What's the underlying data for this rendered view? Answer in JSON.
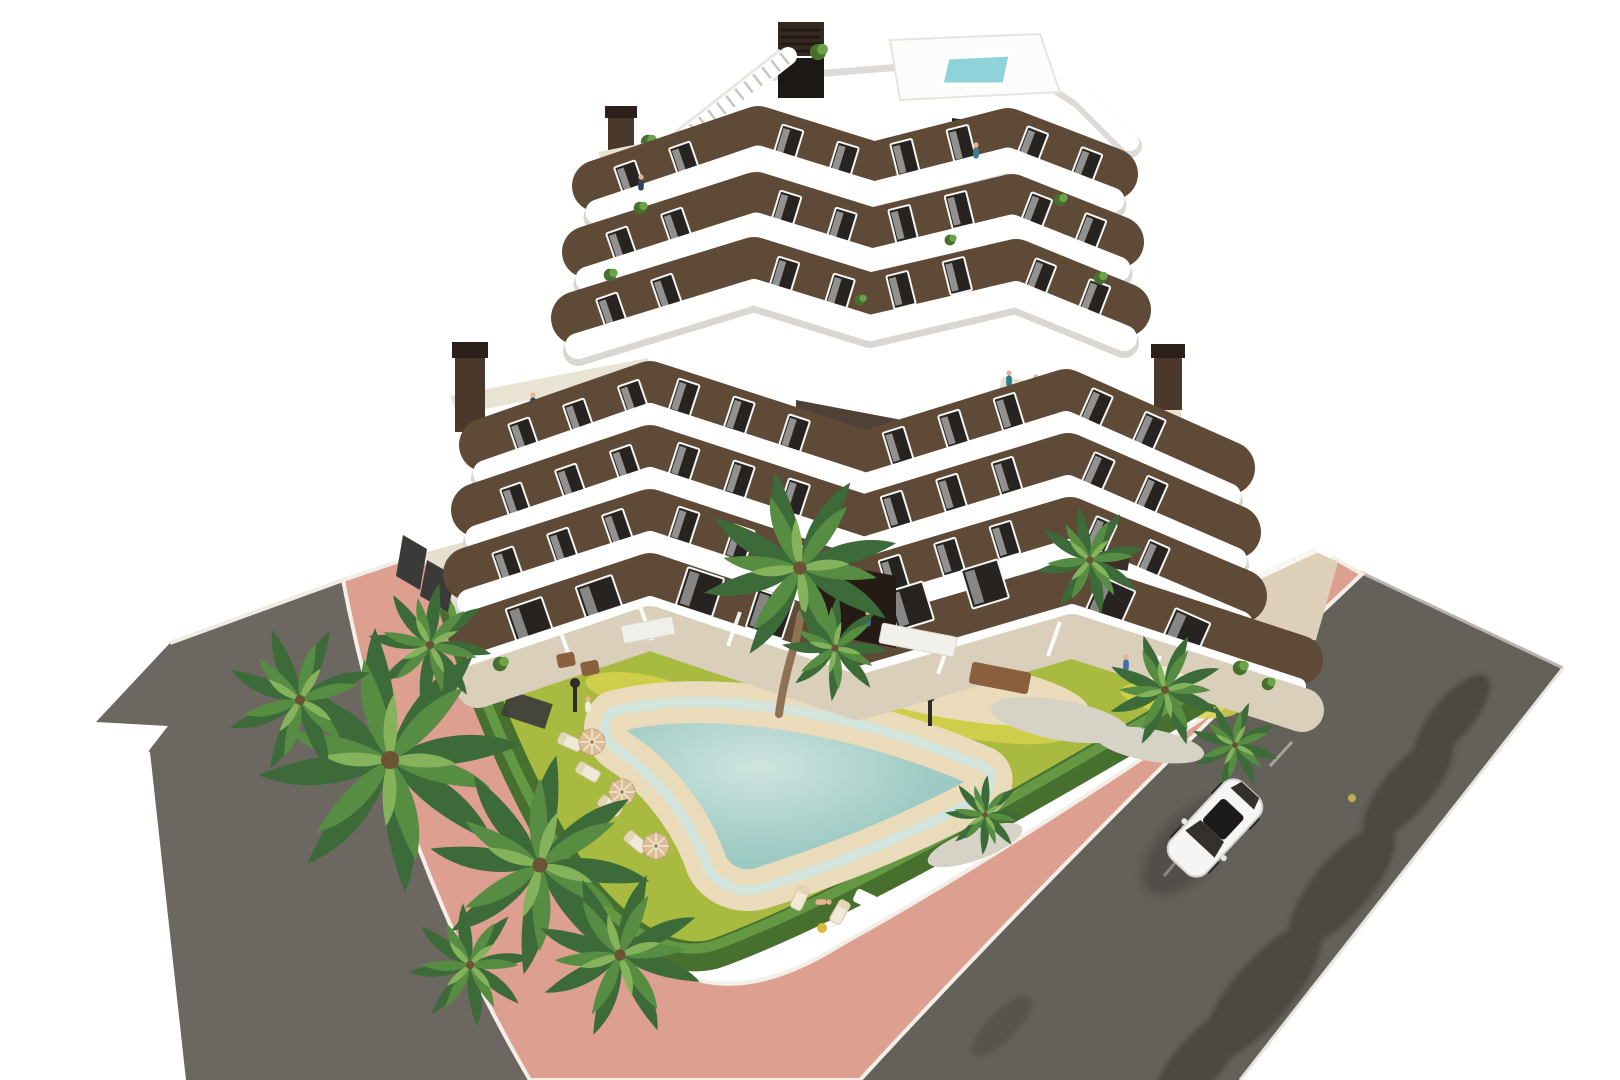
{
  "scene": {
    "description": "Aerial 3D architectural render of a modern seven-storey apartment building with curved white balcony bands and brown facades, a penthouse with rooftop plunge pool and external staircase, corner terraces with chimneys, a communal garden with free-form sand-edged swimming pool, sun loungers and parasols, palm trees, a pink perimeter footpath with white curbs, two asphalt roads and a single white car driving on the east road.",
    "style": "architectural visualization",
    "view": "aerial three-quarter",
    "background": "#ffffff"
  },
  "labels": {
    "building": "Apartment building",
    "penthouse": "Penthouse and roof terrace",
    "rooftop_pool": "Rooftop plunge pool",
    "stairs": "External white staircase",
    "left_terrace": "West corner terrace",
    "right_terrace": "East corner terrace",
    "courtyard": "Recessed courtyard balconies",
    "ground_terraces": "Ground-floor private terraces",
    "garden": "Communal garden",
    "lawn": "Lawn",
    "hedge": "Perimeter hedge",
    "pool": "Free-form swimming pool",
    "pool_beach": "Sand-effect pool beach",
    "loungers": "Sun loungers",
    "parasols": "Parasols",
    "palms": "Palm trees",
    "footpath": "Pink perimeter footpath",
    "road_left": "Asphalt road (west)",
    "road_right": "Asphalt road (east)",
    "car": "White car",
    "shadows": "Tree shadows on road",
    "fence": "Dark privacy fence",
    "walls": "White garden walls",
    "lamps": "Garden lamp posts",
    "flowers": "Flowering lawn patches",
    "pebbles": "Decorative pebble beds",
    "furniture": "Outdoor furniture",
    "people": "Residents"
  },
  "counts": {
    "floors_visible": 7,
    "palm_trees": 12,
    "parasols": 3,
    "sun_loungers": 6,
    "chimneys": 3,
    "lamp_posts": 2,
    "cars": 1
  },
  "palette": {
    "bg": "#ffffff",
    "asphalt_left": "#6d6761",
    "asphalt_right": "#64605a",
    "footpath_pink": "#dd9f90",
    "curb": "#f2efe8",
    "lawn": "#a9ba41",
    "lawn_light": "#c0c64a",
    "flowers": "#d6d24c",
    "hedge": "#47702f",
    "hedge_light": "#6da348",
    "palm_dark": "#3c6b39",
    "palm_mid": "#578c43",
    "palm_light": "#85b35c",
    "trunk": "#8d7253",
    "sand": "#eadcba",
    "pebble": "#d6d2c6",
    "pool_water": "#9fcbc4",
    "pool_rim": "#cfe4df",
    "pool_deep": "#8fc2bb",
    "terrace_beige": "#d9cfba",
    "terrace_light": "#e9e3d4",
    "wall_brown": "#5e4a37",
    "wall_dark": "#3f3227",
    "passage": "#241c14",
    "window": "#262320",
    "frame": "#f6f6f4",
    "slab": "#ffffff",
    "slab_shadow": "#d8d7d2",
    "roof_pool": "#8ed2da",
    "chimney": "#4a382a",
    "chimney_cap": "#2b211a",
    "fence_dark": "#3a3a38",
    "wood": "#8a5f3e",
    "sofa": "#e6e2d8",
    "umbrella": "#dcbd94",
    "car_body": "#f5f5f3",
    "car_glass": "#34312d",
    "wheel": "#2a2826",
    "shadow": "#33302b",
    "lamp": "#2e2d2b",
    "white_wall": "#f7f6f2"
  }
}
